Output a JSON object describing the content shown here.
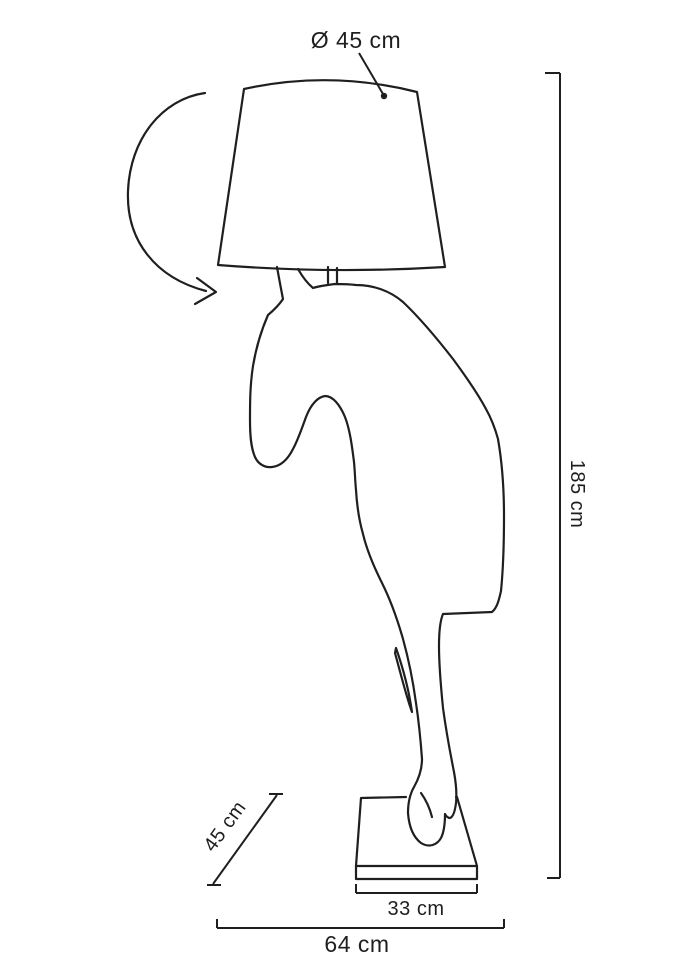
{
  "labels": {
    "shade_diameter": "Ø 45 cm",
    "height": "185 cm",
    "depth": "45 cm",
    "base_width": "33 cm",
    "overall_width": "64 cm"
  },
  "colors": {
    "line": "#1f1f1f",
    "background": "#ffffff"
  },
  "icons": {
    "rotation": "rotation-arrow",
    "leader_end": "leader-dot"
  }
}
